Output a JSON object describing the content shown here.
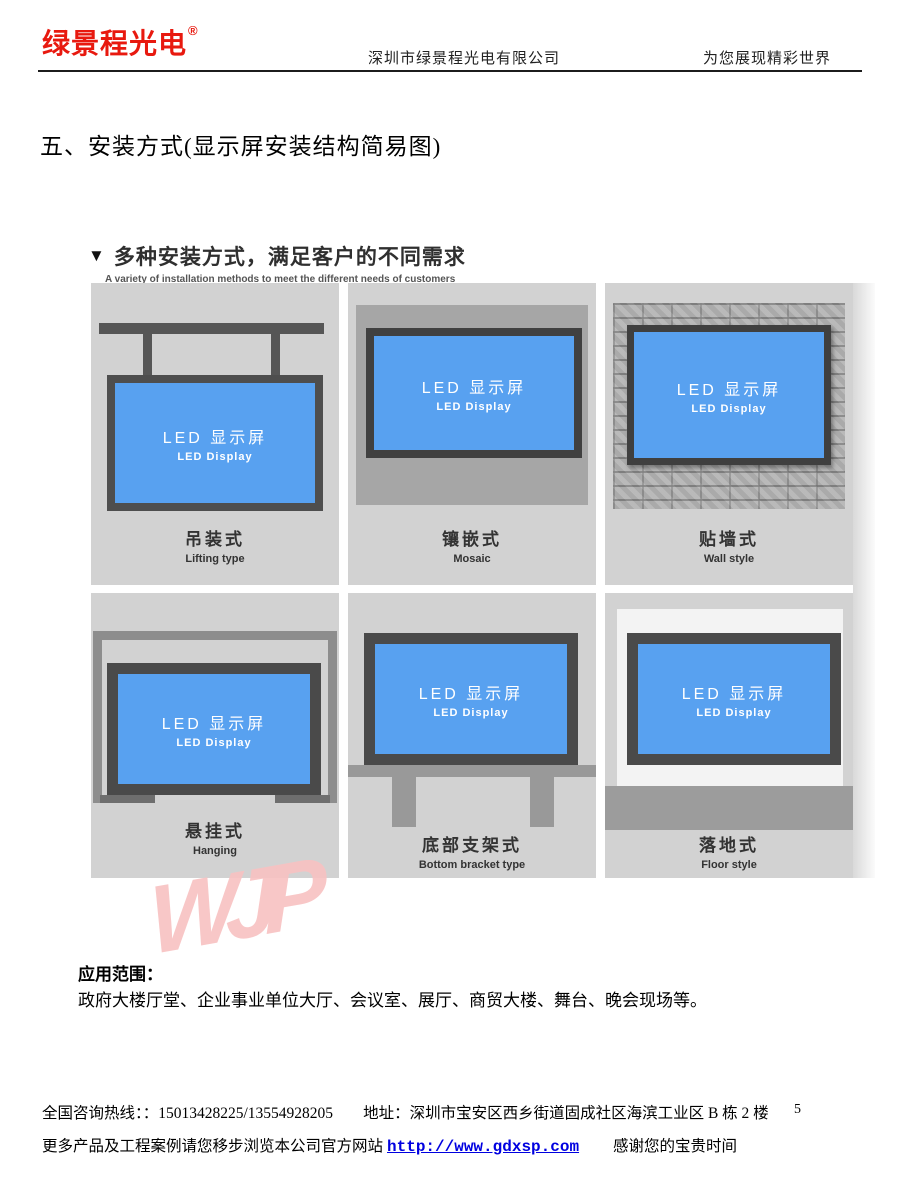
{
  "header": {
    "logo_text": "绿景程光电",
    "logo_reg_mark": "®",
    "logo_color": "#e8190f",
    "company_name": "深圳市绿景程光电有限公司",
    "slogan": "为您展现精彩世界"
  },
  "section_title": "五、安装方式(显示屏安装结构简易图)",
  "diagram": {
    "title_marker": "▼",
    "title": "多种安装方式，满足客户的不同需求",
    "subtitle": "A variety of installation methods to meet the different needs of customers",
    "screen_label_cn": "LED 显示屏",
    "screen_label_en": "LED Display",
    "screen_color": "#58a1f0",
    "frame_color": "#4e4e4e",
    "panels": [
      {
        "id": "lifting",
        "label_cn": "吊装式",
        "label_en": "Lifting type"
      },
      {
        "id": "mosaic",
        "label_cn": "镶嵌式",
        "label_en": "Mosaic"
      },
      {
        "id": "wall-style",
        "label_cn": "贴墙式",
        "label_en": "Wall style"
      },
      {
        "id": "hanging",
        "label_cn": "悬挂式",
        "label_en": "Hanging"
      },
      {
        "id": "bottom-bracket",
        "label_cn": "底部支架式",
        "label_en": "Bottom bracket type"
      },
      {
        "id": "floor-style",
        "label_cn": "落地式",
        "label_en": "Floor style"
      }
    ]
  },
  "watermark": "WJP",
  "watermark_color": "#f8c2c2",
  "application": {
    "heading": "应用范围：",
    "body": "政府大楼厅堂、企业事业单位大厅、会议室、展厅、商贸大楼、舞台、晚会现场等。"
  },
  "footer": {
    "hotline": "全国咨询热线：：15013428225/13554928205",
    "address": "地址：深圳市宝安区西乡街道固成社区海滨工业区 B 栋 2 楼",
    "page_number": "5",
    "line2_prefix": "更多产品及工程案例请您移步浏览本公司官方网站",
    "website": "http://www.gdxsp.com",
    "website_color": "#0000e0",
    "line2_suffix": "感谢您的宝贵时间"
  }
}
